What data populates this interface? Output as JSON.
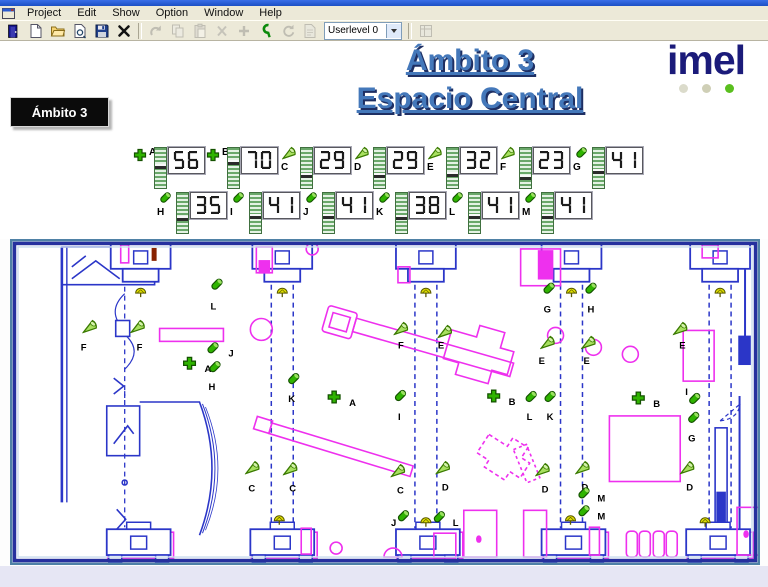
{
  "window": {
    "menu_items": [
      "Project",
      "Edit",
      "Show",
      "Option",
      "Window",
      "Help"
    ]
  },
  "toolbar": {
    "userlevel_value": "Userlevel 0",
    "buttons": [
      {
        "name": "exit-button",
        "icon": "exit",
        "enabled": true
      },
      {
        "name": "new-button",
        "icon": "new",
        "enabled": true
      },
      {
        "name": "open-button",
        "icon": "open",
        "enabled": true
      },
      {
        "name": "import-button",
        "icon": "import",
        "enabled": true
      },
      {
        "name": "save-button",
        "icon": "save",
        "enabled": true
      },
      {
        "name": "delete-button",
        "icon": "delete",
        "enabled": true
      },
      {
        "sep": true
      },
      {
        "name": "undo-button",
        "icon": "undo",
        "enabled": false
      },
      {
        "name": "copy-button",
        "icon": "copy",
        "enabled": false
      },
      {
        "name": "paste-button",
        "icon": "paste",
        "enabled": false
      },
      {
        "name": "cut-button",
        "icon": "cut",
        "enabled": false
      },
      {
        "name": "add-button",
        "icon": "add",
        "enabled": false
      },
      {
        "name": "connect-button",
        "icon": "connect",
        "enabled": true
      },
      {
        "name": "refresh-button",
        "icon": "refresh",
        "enabled": false
      },
      {
        "name": "report-button",
        "icon": "report",
        "enabled": false
      },
      {
        "combo": true
      },
      {
        "sep": true
      },
      {
        "name": "properties-button",
        "icon": "properties",
        "enabled": false
      }
    ]
  },
  "header": {
    "title_line1": "Ámbito 3",
    "title_line2": "Espacio Central",
    "logo_text": "imel",
    "logo_dot_colors": [
      "#dbdbcb",
      "#cfcfb6",
      "#5abf1e"
    ]
  },
  "nav_button": {
    "label": "Ámbito 3"
  },
  "readouts": {
    "row1": [
      {
        "id": "A",
        "value": 56,
        "icon": "plus"
      },
      {
        "id": "B",
        "value": 70,
        "icon": "plus"
      },
      {
        "id": "C",
        "value": 29,
        "icon": "cone"
      },
      {
        "id": "D",
        "value": 29,
        "icon": "cone"
      },
      {
        "id": "E",
        "value": 32,
        "icon": "cone"
      },
      {
        "id": "F",
        "value": 23,
        "icon": "cone"
      },
      {
        "id": "G",
        "value": 41,
        "icon": "cyl"
      }
    ],
    "row2": [
      {
        "id": "H",
        "value": 35,
        "icon": "cyl"
      },
      {
        "id": "I",
        "value": 41,
        "icon": "cyl"
      },
      {
        "id": "J",
        "value": 41,
        "icon": "cyl"
      },
      {
        "id": "K",
        "value": 38,
        "icon": "cyl"
      },
      {
        "id": "L",
        "value": 41,
        "icon": "cyl"
      },
      {
        "id": "M",
        "value": 41,
        "icon": "cyl"
      }
    ]
  },
  "plan": {
    "markers": [
      {
        "letter": "L",
        "type": "cyl",
        "x": 207,
        "y": 46,
        "lx": 201,
        "ly": 71
      },
      {
        "letter": "G",
        "type": "cyl",
        "x": 540,
        "y": 50,
        "lx": 535,
        "ly": 74
      },
      {
        "letter": "H",
        "type": "cyl",
        "x": 582,
        "y": 50,
        "lx": 579,
        "ly": 74
      },
      {
        "letter": "F",
        "type": "cone",
        "x": 80,
        "y": 88,
        "lx": 71,
        "ly": 112
      },
      {
        "letter": "F",
        "type": "cone",
        "x": 128,
        "y": 88,
        "lx": 127,
        "ly": 112
      },
      {
        "letter": "F",
        "type": "cone",
        "x": 392,
        "y": 90,
        "lx": 389,
        "ly": 110
      },
      {
        "letter": "E",
        "type": "cone",
        "x": 436,
        "y": 93,
        "lx": 429,
        "ly": 110
      },
      {
        "letter": "E",
        "type": "cone",
        "x": 539,
        "y": 104,
        "lx": 530,
        "ly": 126
      },
      {
        "letter": "E",
        "type": "cone",
        "x": 580,
        "y": 104,
        "lx": 575,
        "ly": 126
      },
      {
        "letter": "E",
        "type": "cone",
        "x": 672,
        "y": 90,
        "lx": 671,
        "ly": 110
      },
      {
        "letter": "J",
        "type": "cyl",
        "x": 203,
        "y": 110,
        "lx": 219,
        "ly": 118
      },
      {
        "letter": "A",
        "type": "plus",
        "x": 180,
        "y": 125,
        "lx": 195,
        "ly": 134
      },
      {
        "letter": "H",
        "type": "cyl",
        "x": 205,
        "y": 129,
        "lx": 199,
        "ly": 152
      },
      {
        "letter": "K",
        "type": "cyl",
        "x": 284,
        "y": 141,
        "lx": 279,
        "ly": 164
      },
      {
        "letter": "A",
        "type": "plus",
        "x": 325,
        "y": 159,
        "lx": 340,
        "ly": 168
      },
      {
        "letter": "I",
        "type": "cyl",
        "x": 391,
        "y": 158,
        "lx": 389,
        "ly": 182
      },
      {
        "letter": "B",
        "type": "plus",
        "x": 485,
        "y": 158,
        "lx": 500,
        "ly": 167
      },
      {
        "letter": "B",
        "type": "plus",
        "x": 630,
        "y": 160,
        "lx": 645,
        "ly": 169
      },
      {
        "letter": "L",
        "type": "cyl",
        "x": 522,
        "y": 159,
        "lx": 518,
        "ly": 182
      },
      {
        "letter": "K",
        "type": "cyl",
        "x": 541,
        "y": 159,
        "lx": 538,
        "ly": 182
      },
      {
        "letter": "I",
        "type": "cyl",
        "x": 686,
        "y": 161,
        "lx": 677,
        "ly": 157
      },
      {
        "letter": "G",
        "type": "cyl",
        "x": 685,
        "y": 180,
        "lx": 680,
        "ly": 204
      },
      {
        "letter": "C",
        "type": "cone",
        "x": 243,
        "y": 230,
        "lx": 239,
        "ly": 254
      },
      {
        "letter": "C",
        "type": "cone",
        "x": 281,
        "y": 231,
        "lx": 280,
        "ly": 254
      },
      {
        "letter": "C",
        "type": "cone",
        "x": 389,
        "y": 233,
        "lx": 388,
        "ly": 256
      },
      {
        "letter": "D",
        "type": "cone",
        "x": 434,
        "y": 230,
        "lx": 433,
        "ly": 253
      },
      {
        "letter": "D",
        "type": "cone",
        "x": 534,
        "y": 232,
        "lx": 533,
        "ly": 255
      },
      {
        "letter": "D",
        "type": "cone",
        "x": 574,
        "y": 230,
        "lx": 573,
        "ly": 253
      },
      {
        "letter": "D",
        "type": "cone",
        "x": 679,
        "y": 230,
        "lx": 678,
        "ly": 253
      },
      {
        "letter": "M",
        "type": "cyl",
        "x": 575,
        "y": 256,
        "lx": 589,
        "ly": 264
      },
      {
        "letter": "M",
        "type": "cyl",
        "x": 575,
        "y": 274,
        "lx": 589,
        "ly": 282
      },
      {
        "letter": "J",
        "type": "cyl",
        "x": 394,
        "y": 279,
        "lx": 382,
        "ly": 289
      },
      {
        "letter": "L",
        "type": "cyl",
        "x": 430,
        "y": 280,
        "lx": 444,
        "ly": 289
      }
    ]
  },
  "colors": {
    "title_blue": "#4478ba",
    "logo_navy": "#1b1b7a",
    "cad_blue": "#2b36c8",
    "cad_magenta": "#ee30ee",
    "icon_green": "#2fb400"
  }
}
